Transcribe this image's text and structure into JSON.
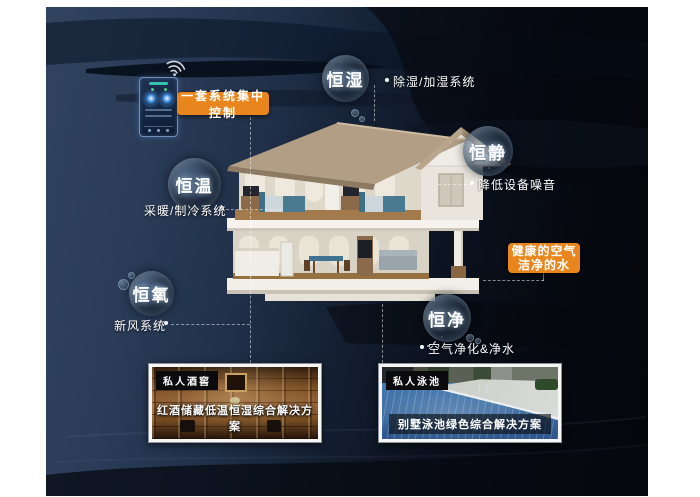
{
  "control_panel": {
    "label": "一套系统集中控制"
  },
  "bubbles": {
    "humidity": {
      "label": "恒湿",
      "sub": "除湿/加湿系统"
    },
    "quiet": {
      "label": "恒静",
      "sub": "降低设备噪音"
    },
    "temp": {
      "label": "恒温",
      "sub": "采暖/制冷系统"
    },
    "oxygen": {
      "label": "恒氧",
      "sub": "新风系统"
    },
    "purity": {
      "label": "恒净",
      "sub": "空气净化&净水"
    }
  },
  "highlight": {
    "line1": "健康的空气",
    "line2": "洁净的水"
  },
  "photos": {
    "wine": {
      "tag": "私人酒窖",
      "caption": "红酒储藏低温恒湿综合解决方案"
    },
    "pool": {
      "tag": "私人泳池",
      "caption": "别墅泳池绿色综合解决方案"
    }
  },
  "colors": {
    "accent_orange": "#e8861d",
    "canvas_navy": "#2a3c58",
    "canvas_black": "#04060b",
    "bubble_text": "#ffffff"
  }
}
